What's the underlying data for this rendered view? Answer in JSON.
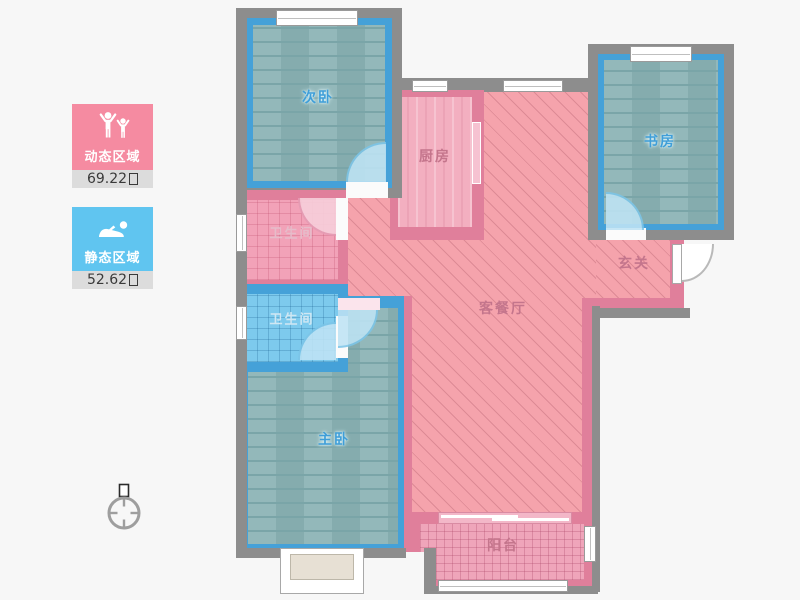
{
  "legend": {
    "dynamic_area": {
      "label": "动态区域",
      "value": "69.22",
      "unit": "㎡",
      "icon": "people-cheering-icon"
    },
    "static_area": {
      "label": "静态区域",
      "value": "52.62",
      "unit": "㎡",
      "icon": "person-lying-icon"
    }
  },
  "compass": {
    "north_marker": "北"
  },
  "rooms": {
    "bedroom_second": {
      "label": "次卧"
    },
    "kitchen": {
      "label": "厨房"
    },
    "study": {
      "label": "书房"
    },
    "bathroom_shared": {
      "label": "卫生间"
    },
    "bathroom_master": {
      "label": "卫生间"
    },
    "living_dining": {
      "label": "客餐厅"
    },
    "foyer": {
      "label": "玄关"
    },
    "bedroom_master": {
      "label": "主卧"
    },
    "balcony": {
      "label": "阳台"
    }
  },
  "colors": {
    "bg": "#f7f7f7",
    "wall_gray": "#8d8d8d",
    "wall_blue": "#45a1d8",
    "wall_pink": "#e07f9b",
    "floor_wood": "#8cb4b6",
    "floor_wood_dark": "#7aa5a8",
    "fill_pink": "#f5a3ac",
    "hatch_line": "#dd8a95",
    "bath_pink": "#f2a2b8",
    "bath_blue": "#7dcaed",
    "kitchen_pink": "#f3afc0",
    "balcony_pink": "#efa5ba",
    "arc_blue_fill": "#bfe4f5",
    "arc_blue_line": "#7cc5e8",
    "arc_pink_fill": "#f7cfdb",
    "arc_pink_line": "#e59cb4",
    "label_blue": "#3f9ed8",
    "label_pink": "#c4758c",
    "label_pink_light": "#e6bcca",
    "label_blue_light": "#cfe7f3",
    "legend_pink": "#f58ba1",
    "legend_blue": "#60c5f0",
    "legend_strip": "#dcdcdc",
    "legend_text": "#3a3a3a"
  }
}
